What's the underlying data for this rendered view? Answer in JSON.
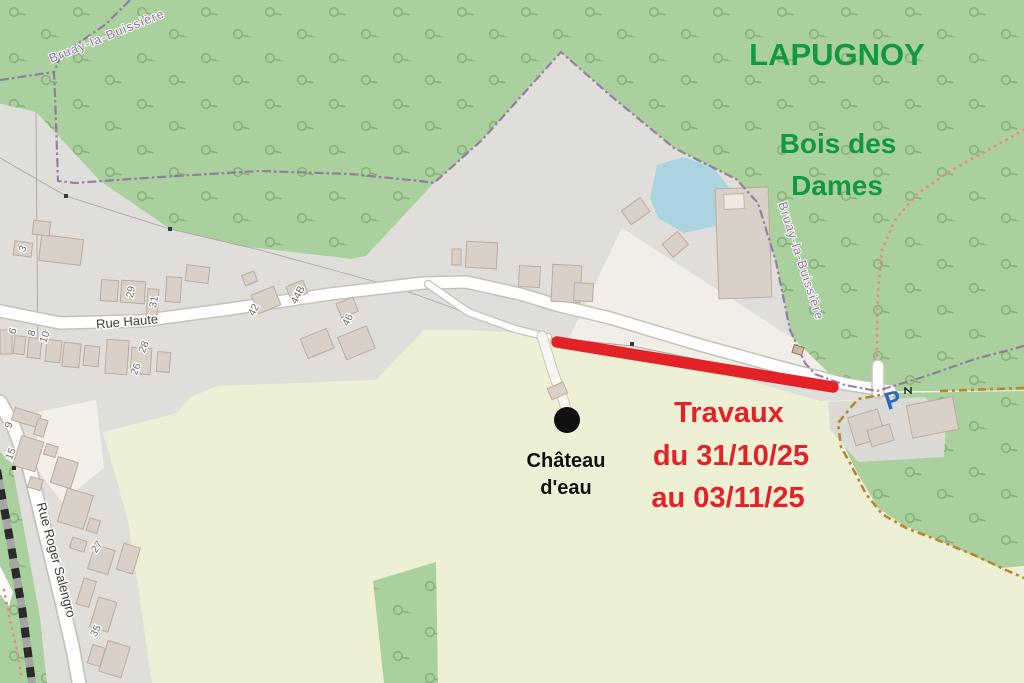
{
  "map_annotations": {
    "place": "LAPUGNOY",
    "forest_name": [
      "Bois des",
      "Dames"
    ],
    "works_notice": [
      "Travaux",
      "du 31/10/25",
      "au 03/11/25"
    ],
    "poi": [
      "Château",
      "d'eau"
    ]
  },
  "streets": {
    "rue_haute": "Rue Haute",
    "rue_roger_salengro": "Rue Roger Salengro"
  },
  "boundaries": {
    "top_label": "Bruay-la-Buissière",
    "right_label": "Bruay-la-Buissière"
  },
  "parking": {
    "label": "P"
  },
  "house_numbers": [
    "3",
    "6",
    "8",
    "10",
    "29",
    "31",
    "26",
    "28",
    "42",
    "44B",
    "46",
    "9",
    "15",
    "27",
    "35"
  ],
  "colors": {
    "forest": "#aad09d",
    "farmland": "#eef0d6",
    "residential": "#e0dedb",
    "water": "#abd4e0",
    "building": "#d9d0c8",
    "works_red": "#e32227",
    "annotation_green": "#119a3d",
    "boundary_purple": "#8d6f9f",
    "parking_blue": "#2468c5",
    "path_orange": "#b8872e"
  }
}
